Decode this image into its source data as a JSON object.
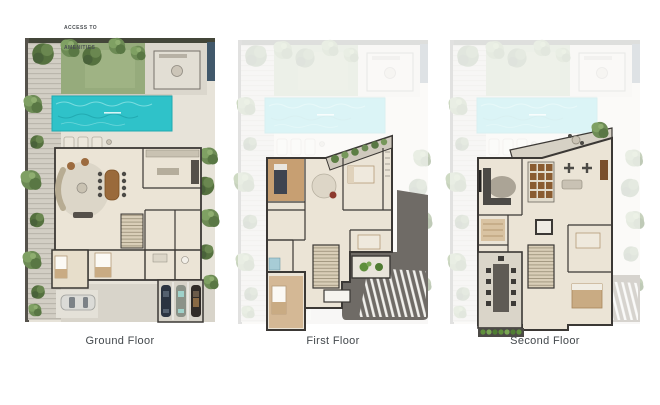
{
  "annotations": {
    "access_line1": "ACCESS TO",
    "access_line2": "AMENITIES"
  },
  "panels": [
    {
      "id": "ground-floor",
      "label": "Ground Floor"
    },
    {
      "id": "first-floor",
      "label": "First Floor"
    },
    {
      "id": "second-floor",
      "label": "Second Floor"
    }
  ],
  "palette": {
    "background": "#ffffff",
    "pool": "#2fc2c9",
    "pool_faded": "#cdecee",
    "lawn": "#96ab7c",
    "tree_dark": "#55713f",
    "tree_light": "#7d9a5c",
    "paving": "#d9d5ca",
    "deck": "#d2cec4",
    "floor": "#ebe4d6",
    "wood_floor": "#c79f72",
    "wall": "#3b3835",
    "furniture_wood": "#9a6a3b",
    "roof_dark": "#6f6b66",
    "slat_white": "#f2f1ed",
    "planter_green": "#5f8f3c",
    "water_feature": "#41586b",
    "label_text": "#43484c"
  }
}
